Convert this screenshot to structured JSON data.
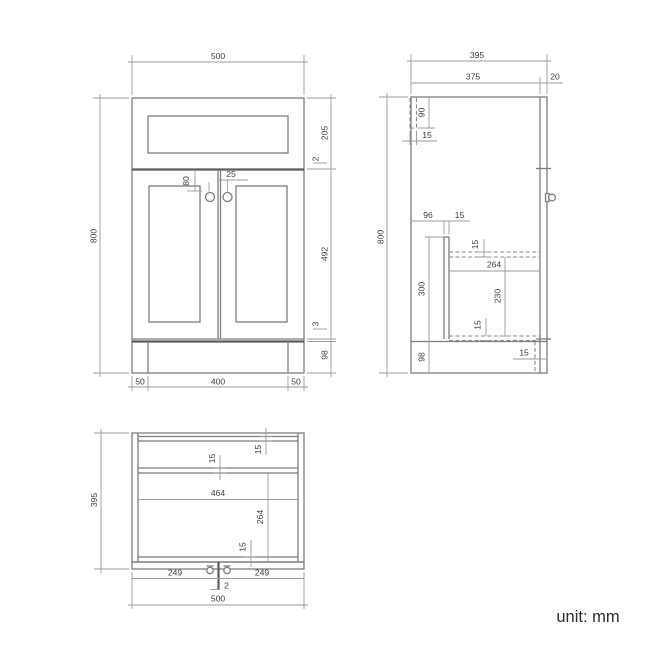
{
  "unit_label": "unit: mm",
  "front_view": {
    "dim_width": "500",
    "dim_height": "800",
    "dim_top_section_height": "205",
    "dim_top_gap": "2",
    "dim_door_height": "492",
    "dim_bottom_gap": "3",
    "dim_plinth_height": "98",
    "dim_handle_drop": "80",
    "dim_handle_offset": "25",
    "dim_leg_left_width": "50",
    "dim_leg_span": "400",
    "dim_leg_right_width": "50"
  },
  "side_view": {
    "dim_total_depth": "395",
    "dim_carcass_depth": "375",
    "dim_front_thickness": "20",
    "dim_height": "800",
    "dim_back_rail_height": "90",
    "dim_back_rail_thickness": "15",
    "dim_runner_setback": "96",
    "dim_runner_thickness": "15",
    "dim_shelf_thickness": "15",
    "dim_shelf_depth": "264",
    "dim_shelf_to_bottom": "230",
    "dim_runner_height": "300",
    "dim_bottom_panel_thickness": "15",
    "dim_plinth_height": "98",
    "dim_back_leg_thickness": "15"
  },
  "plan_view": {
    "dim_depth": "395",
    "dim_back_panel_thickness": "15",
    "dim_rail_thickness": "15",
    "dim_interior_width": "464",
    "dim_interior_depth": "264",
    "dim_front_panel_thickness": "15",
    "dim_door_left_width": "249",
    "dim_door_gap": "2",
    "dim_door_right_width": "249",
    "dim_width": "500"
  }
}
